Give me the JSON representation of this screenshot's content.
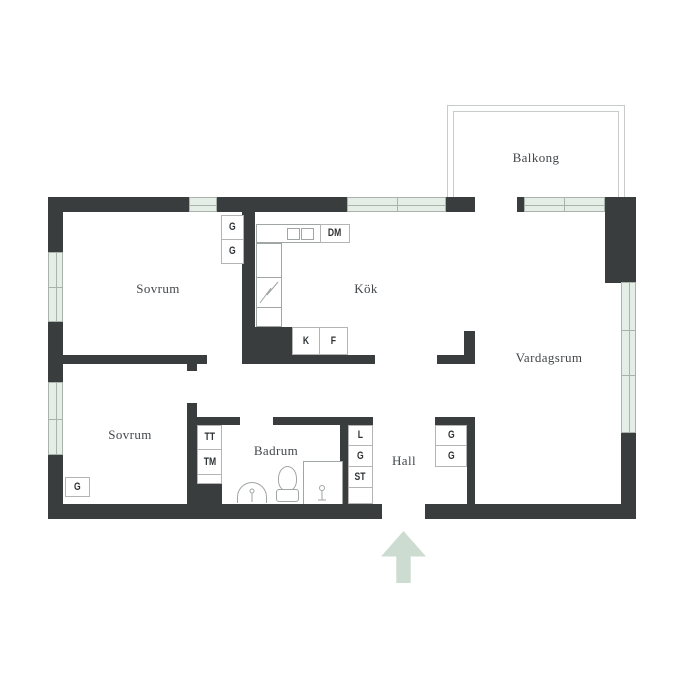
{
  "plan": {
    "rooms": {
      "balcony": "Balkong",
      "bedroom_top": "Sovrum",
      "kitchen": "Kök",
      "living_room": "Vardagsrum",
      "bedroom_bottom": "Sovrum",
      "bathroom": "Badrum",
      "hall": "Hall"
    },
    "closets": {
      "bedroom_top_g1": "G",
      "bedroom_top_g2": "G",
      "kitchen_dm": "DM",
      "kitchen_k": "K",
      "kitchen_f": "F",
      "laundry_tt": "TT",
      "laundry_tm": "TM",
      "hall_l": "L",
      "hall_g": "G",
      "hall_st": "ST",
      "hall_g1": "G",
      "hall_g2": "G",
      "bedroom_bottom_g": "G"
    },
    "colors": {
      "wall": "#393d3d",
      "window_fill": "#e4ede6",
      "window_line": "#a9b2ab",
      "balcony_line": "#c7ccc9",
      "fixture_line": "#9fa6a4",
      "closet_line": "#b4b4b4",
      "arrow": "#cddcd0",
      "room_label": "#43474a",
      "closet_label": "#2e3234"
    }
  }
}
